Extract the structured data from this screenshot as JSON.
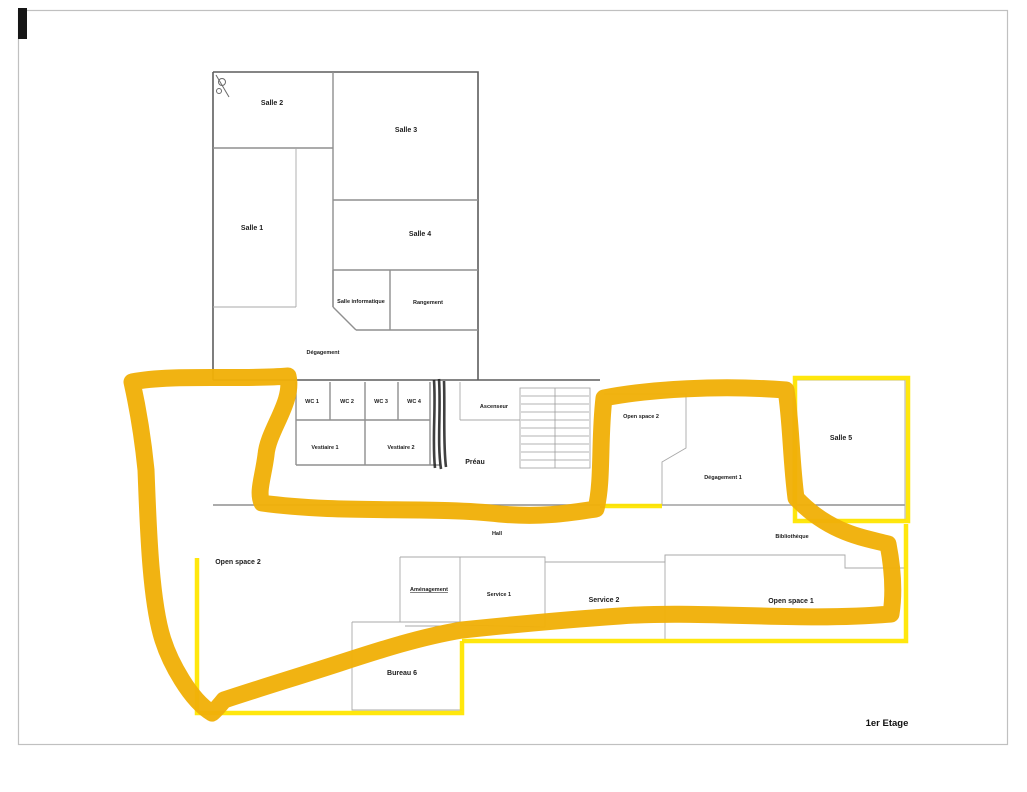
{
  "page": {
    "type": "scanned floor plan with highlighter annotations",
    "background": "#ffffff",
    "border_color": "#c0c0c0",
    "floor_label": "1er Etage"
  },
  "colors": {
    "marker_highlight": "#f0b008",
    "thin_outline": "#ffe600",
    "wall": "#8f8f8f",
    "text": "#1c1c1c"
  },
  "rooms": {
    "salle_2": "Salle 2",
    "salle_1": "Salle 1",
    "salle_3": "Salle 3",
    "salle_4": "Salle 4",
    "salle_informatique": "Salle informatique",
    "rangement": "Rangement",
    "degagement": "Dégagement",
    "wc_1": "WC 1",
    "wc_2": "WC 2",
    "wc_3": "WC 3",
    "wc_4": "WC 4",
    "vestiaire_1": "Vestiaire 1",
    "vestiaire_2": "Vestiaire 2",
    "preau": "Préau",
    "ascenseur": "Ascenseur",
    "open_space_2_upper": "Open space 2",
    "degagement_1": "Dégagement 1",
    "salle_5": "Salle 5",
    "open_space_2": "Open space 2",
    "bibliotheque": "Bibliothèque",
    "hall": "Hall",
    "amenagement": "Aménagement",
    "service_1": "Service 1",
    "service_2": "Service 2",
    "open_space_1": "Open space 1",
    "bureau_6": "Bureau 6"
  }
}
